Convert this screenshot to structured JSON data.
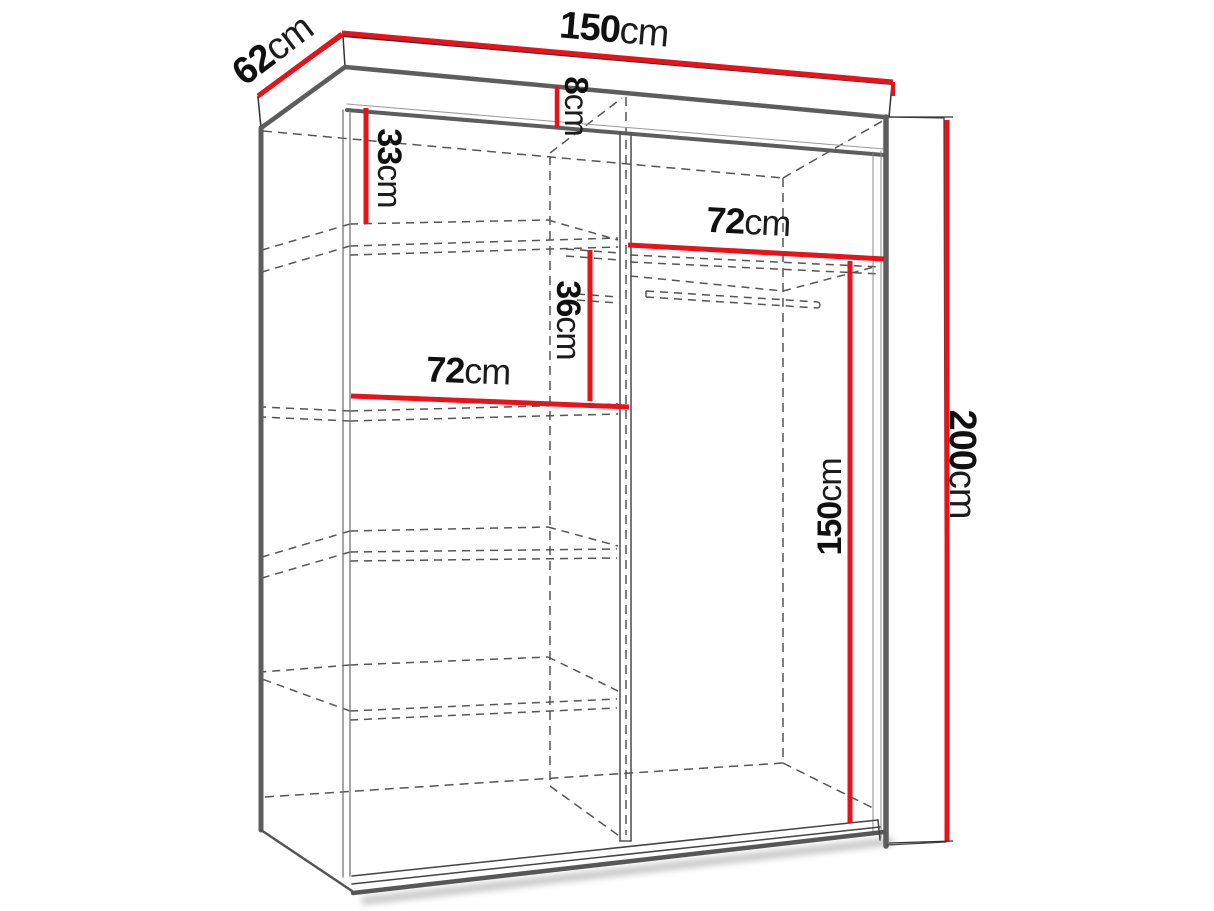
{
  "diagram": {
    "type": "furniture-dimension-diagram",
    "subject": "wardrobe carcass wireframe with shelves and hanging rail, perspective front view",
    "accent_color": "#e8121a",
    "line_color": "#3a3a3a",
    "dashed_color": "#555555",
    "dimensions": {
      "depth": {
        "value": "62",
        "unit": "cm"
      },
      "width": {
        "value": "150",
        "unit": "cm"
      },
      "top_panel": {
        "value": "8",
        "unit": "cm"
      },
      "top_shelf_gap": {
        "value": "33",
        "unit": "cm"
      },
      "left_shelf_width": {
        "value": "72",
        "unit": "cm"
      },
      "middle_gap": {
        "value": "36",
        "unit": "cm"
      },
      "right_section_width": {
        "value": "72",
        "unit": "cm"
      },
      "hanging_height": {
        "value": "150",
        "unit": "cm"
      },
      "total_height": {
        "value": "200",
        "unit": "cm"
      }
    }
  }
}
